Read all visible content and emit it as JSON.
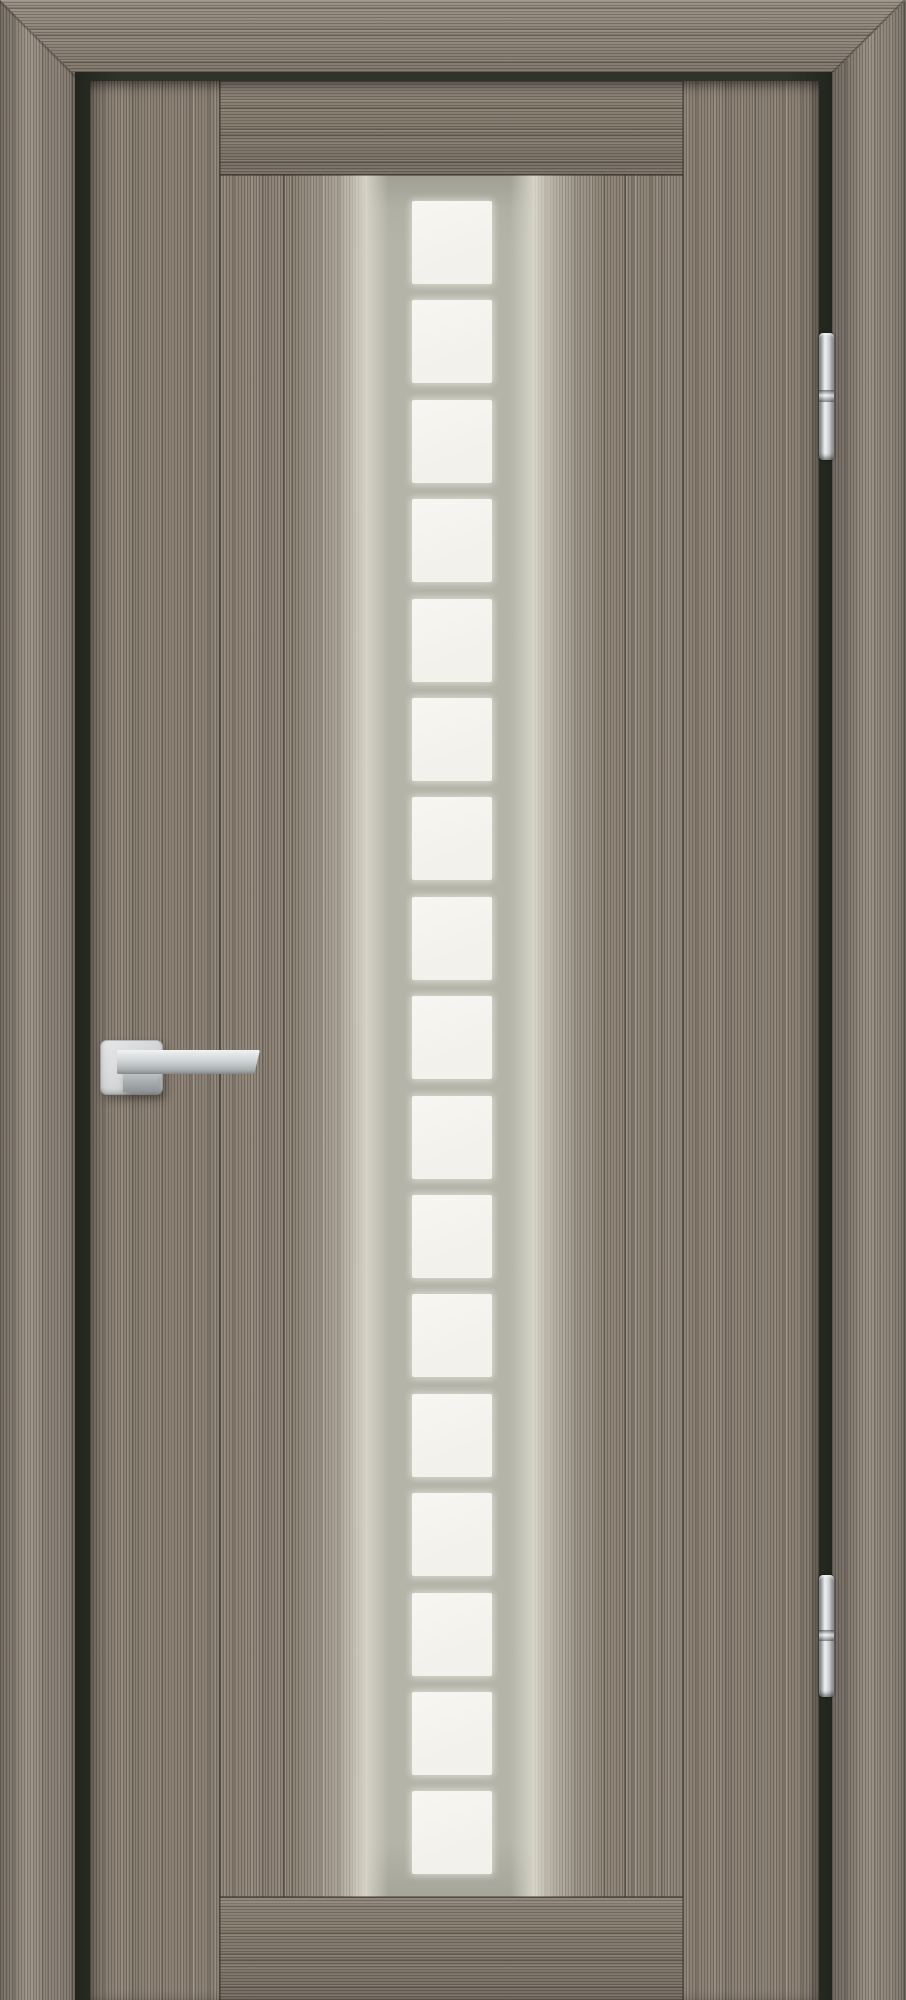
{
  "scene": {
    "type": "product-photo",
    "subject": "Interior door, grey wood-grain laminate, central vertical frosted-glass strip, satin chrome hardware",
    "width_px": 906,
    "height_px": 2000
  },
  "door": {
    "finish": {
      "wood_base": "#8c8276",
      "frame_wood": "#948a7e",
      "stile_wood": "#8b8175",
      "rail_wood": "#897f73",
      "board_wood": "#8e8478",
      "reveal_shadow": "#2e3228"
    },
    "glass": {
      "pane_count": 17,
      "pane_color": "#f2f1ec",
      "mullion_color": "#b4b4a8",
      "first_pane_offset_px": 26,
      "pane_pitch_px": 99.4,
      "pane_height_px": 83
    },
    "hardware": {
      "handle": {
        "type": "lever on square rosette",
        "finish_color": "#d3d5d6"
      },
      "hinges": {
        "count": 2,
        "finish_color": "#eff1f1"
      }
    }
  }
}
